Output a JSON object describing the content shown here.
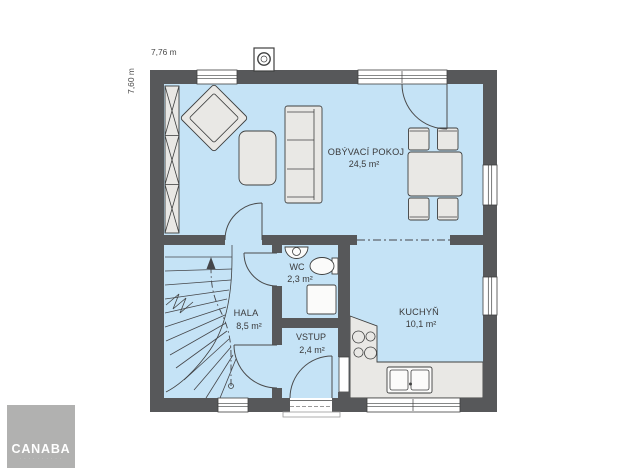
{
  "plan": {
    "width_label": "7,76 m",
    "height_label": "7,60 m",
    "rooms": {
      "living": {
        "name": "OBÝVACÍ POKOJ",
        "area": "24,5 m²"
      },
      "kitchen": {
        "name": "KUCHYŇ",
        "area": "10,1 m²"
      },
      "hall": {
        "name": "HALA",
        "area": "8,5 m²"
      },
      "wc": {
        "name": "WC",
        "area": "2,3 m²"
      },
      "entry": {
        "name": "VSTUP",
        "area": "2,4 m²"
      }
    },
    "colors": {
      "wall": "#57585a",
      "floor": "#c5e3f6",
      "furniture": "#e9e8e5",
      "logo_bg": "#b1b1b0"
    }
  },
  "logo": {
    "brand": "CANABA",
    "tagline": "· · · · · · · · · ·"
  }
}
